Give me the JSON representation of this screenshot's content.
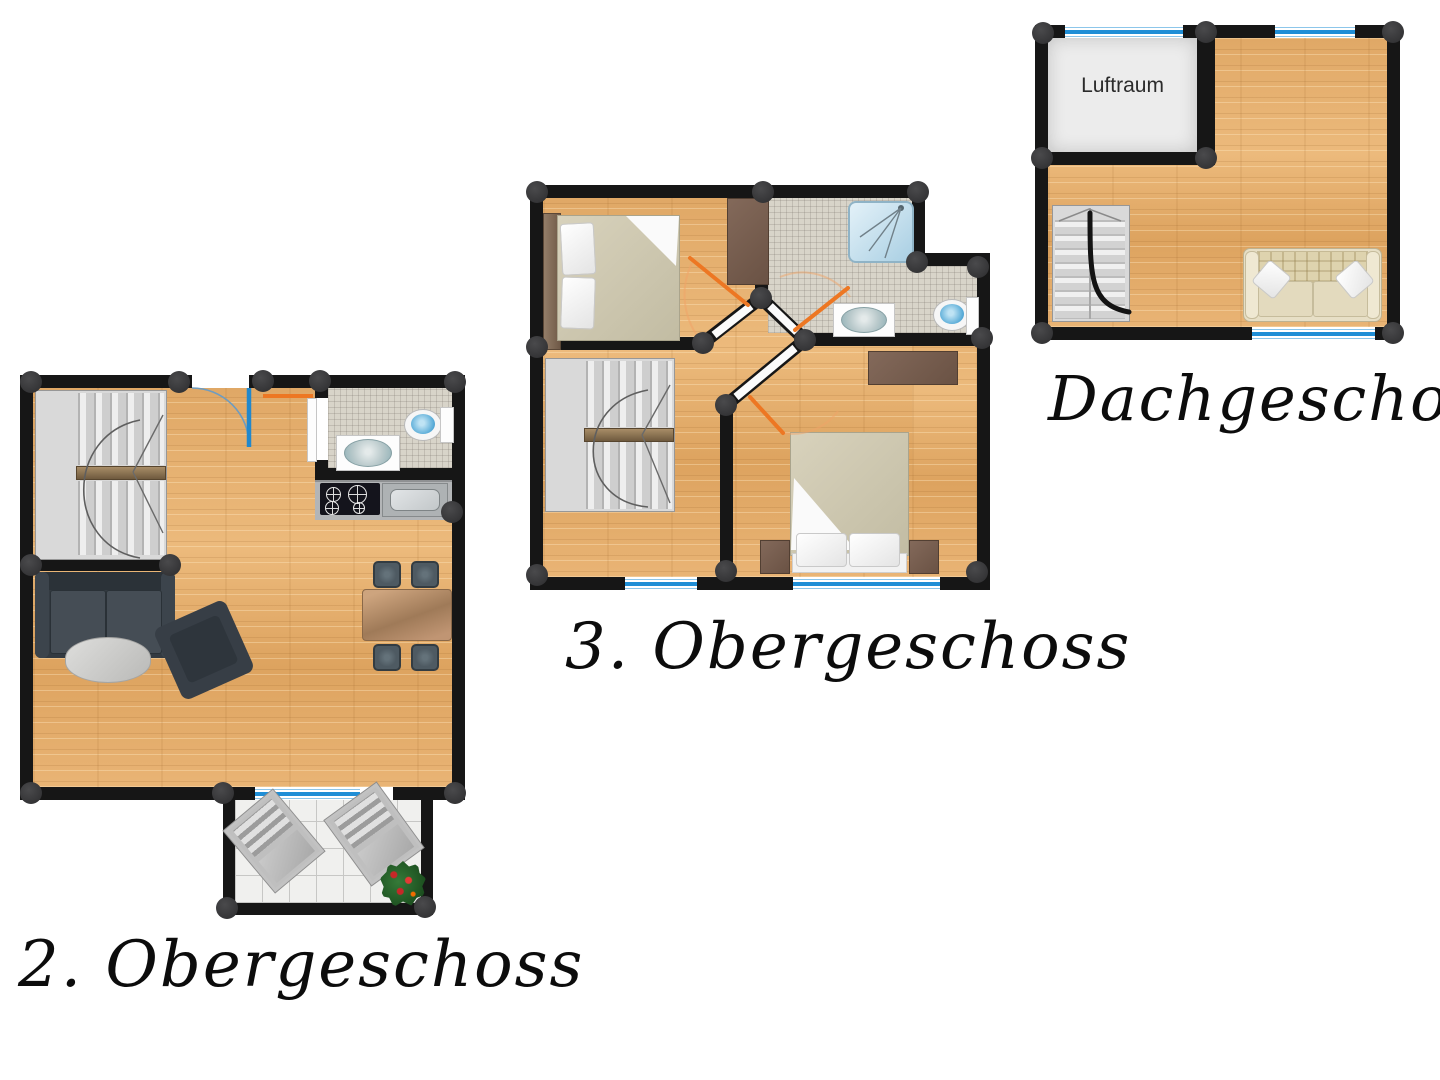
{
  "plans": [
    {
      "id": "og2",
      "title": "2. Obergeschoss"
    },
    {
      "id": "og3",
      "title": "3. Obergeschoss"
    },
    {
      "id": "dach",
      "title": "Dachgeschoss",
      "rooms": [
        {
          "label": "Luftraum"
        }
      ]
    }
  ],
  "colors": {
    "wall": "#161616",
    "wood_floor": "#e5af6e",
    "bathroom_tile": "#d8d4c9",
    "balcony_tile": "#f0f0ee",
    "window_blue": "#1f8ed6",
    "door_swing_orange": "#ed7723",
    "door_leaf_blue": "#2288cc",
    "connector_dot": "#3a3a3c"
  }
}
